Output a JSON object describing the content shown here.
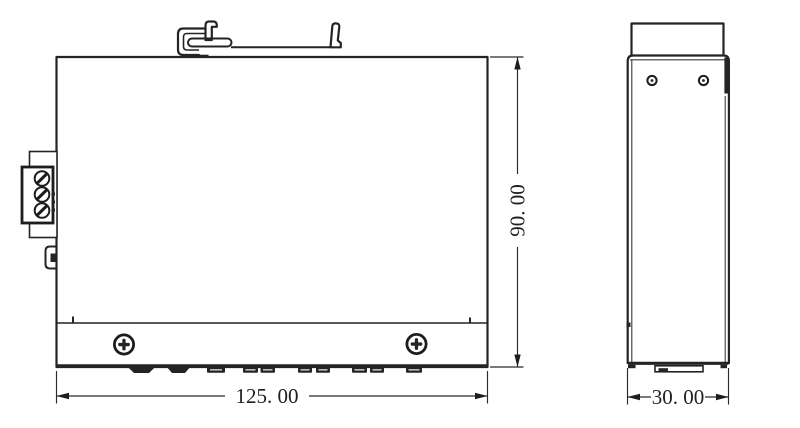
{
  "drawing": {
    "type": "mechanical-dimension-drawing",
    "colors": {
      "line": "#242424",
      "text": "#1f1f1f",
      "background": "#ffffff"
    },
    "dimensions": {
      "front_width": {
        "label": "125. 00"
      },
      "front_height": {
        "label": "90. 00"
      },
      "side_depth": {
        "label": "30. 00"
      }
    }
  }
}
